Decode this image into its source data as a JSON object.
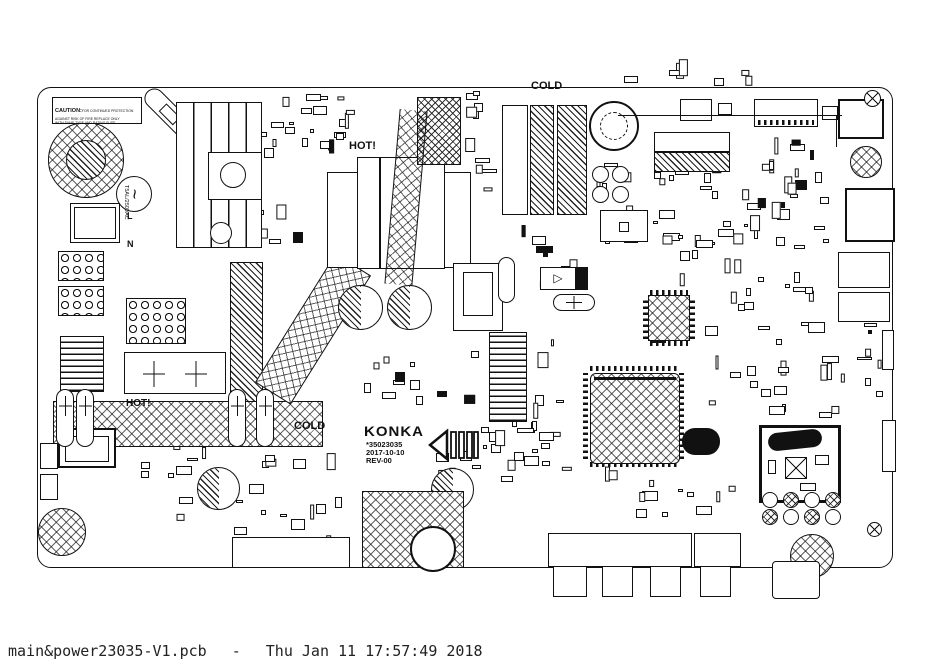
{
  "statusbar": {
    "filename": "main&power23035-V1.pcb",
    "separator": "-",
    "timestamp": "Thu Jan 11 17:57:49 2018"
  },
  "board": {
    "caution": {
      "title": "CAUTION:",
      "line1": "FOR CONTINUED PROTECTION",
      "line2": "AGAINST RISK OF FIRE REPLACE ONLY",
      "line3": "WITH SAME TYPE AND RATING FUSE"
    },
    "zone_labels": {
      "hot_primary": "HOT!",
      "hot_secondary": "HOT!",
      "cold_top": "COLD",
      "cold_bottom": "COLD"
    },
    "power_input": {
      "line": "L",
      "neutral": "N",
      "ac_symbol": "~",
      "fuse_rating": "T5AL/250VAC"
    },
    "title_block": {
      "brand": "KONKA",
      "part_number": "*35023035",
      "date": "2017-10-10",
      "revision": "REV-00"
    }
  },
  "colors": {
    "silkscreen": "#111111",
    "background": "#ffffff"
  }
}
